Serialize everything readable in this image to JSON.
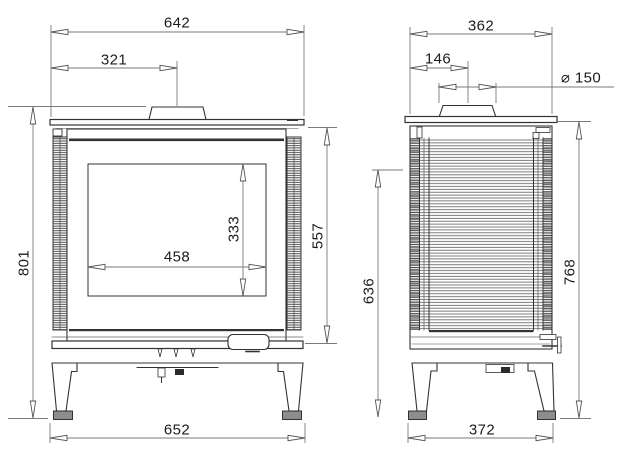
{
  "diagram": {
    "views": {
      "front": {
        "width_top": "642",
        "flue_center_offset": "321",
        "height_overall": "801",
        "glass_width": "458",
        "glass_height": "333",
        "body_height": "557",
        "width_base": "652"
      },
      "side": {
        "depth_top": "362",
        "flue_center_offset": "146",
        "flue_diameter": "⌀ 150",
        "height_mid": "636",
        "height_body": "768",
        "depth_base": "372"
      }
    },
    "colors": {
      "object_line": "#333333",
      "dimension_line": "#7a7a7a",
      "background": "#ffffff"
    }
  }
}
